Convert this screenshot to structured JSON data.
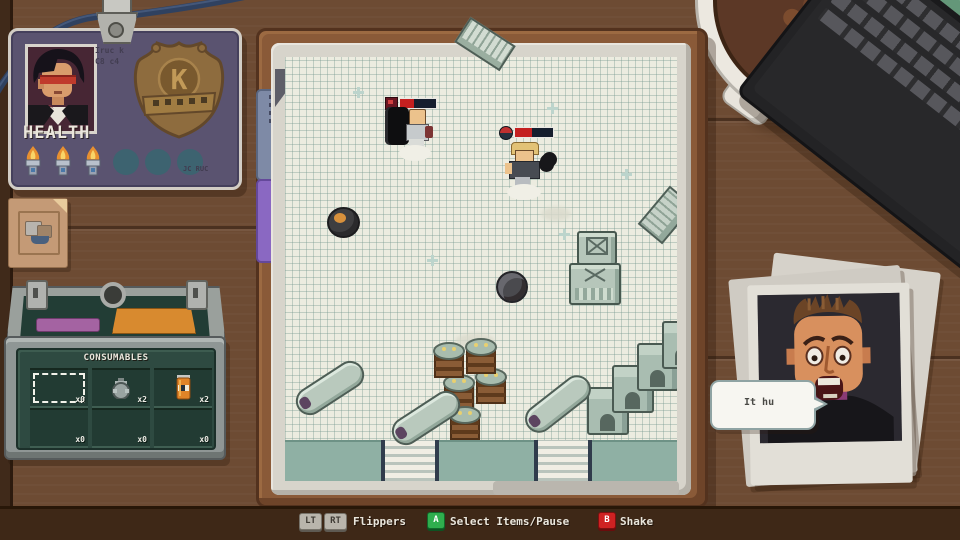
{
  "id_card": {
    "name_line1": "Iruc k",
    "name_line2": "C8 c4",
    "health_label": "HEALTH",
    "badge_letter": "K",
    "serial": "JC RUC"
  },
  "consumables": {
    "title": "CONSUMABLES",
    "slots": [
      {
        "item": "empty-selected",
        "count": "x0"
      },
      {
        "item": "grenade",
        "count": "x2"
      },
      {
        "item": "soda-can",
        "count": "x2"
      },
      {
        "item": "empty",
        "count": "x0"
      },
      {
        "item": "empty",
        "count": "x0"
      },
      {
        "item": "empty",
        "count": "x0"
      }
    ]
  },
  "speech": {
    "text": "It hu"
  },
  "enemies": {
    "enemy1_health": "40%",
    "enemy2_health": "45%"
  },
  "controls": {
    "flippers_key1": "LT",
    "flippers_key2": "RT",
    "flippers_label": "Flippers",
    "select_key": "A",
    "select_label": "Select Items/Pause",
    "shake_key": "B",
    "shake_label": "Shake"
  },
  "colors": {
    "desk": "#6d4b33",
    "paper": "#ecece0",
    "teal_band": "#8fb0a4",
    "card": "#5a5370",
    "box_green": "#2e4a41",
    "key_green": "#2fae4e",
    "key_red": "#cf2222",
    "health_fill": "#c42020"
  }
}
